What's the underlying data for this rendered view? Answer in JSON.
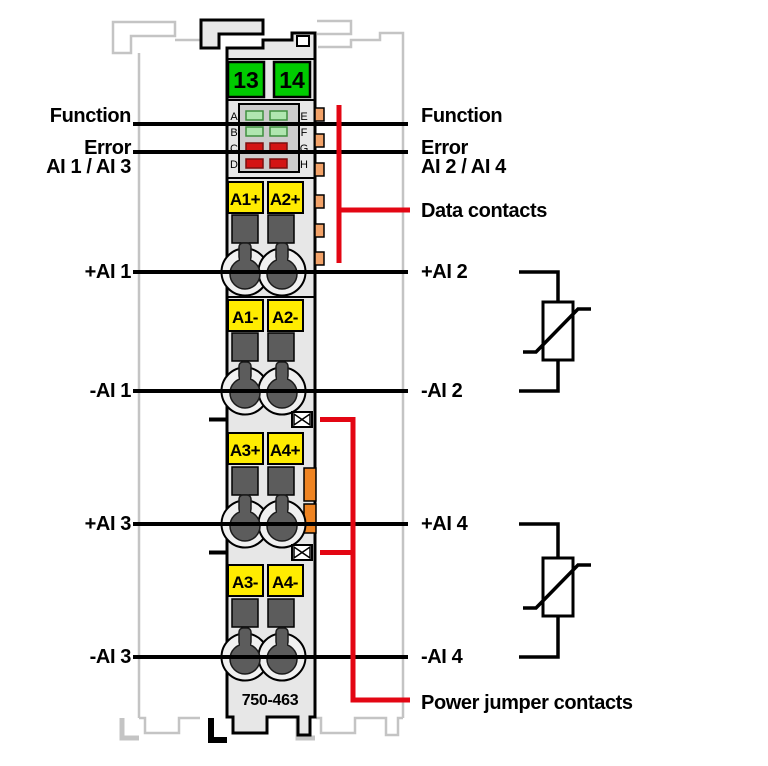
{
  "colors": {
    "body": "#e7e7e7",
    "panel": "#cccccc",
    "neighbor": "#c4c4c4",
    "green": "#00cc00",
    "yellow": "#ffec00",
    "red": "#e30613",
    "contact_orange": "#f2a268",
    "jumper_orange": "#ef8422",
    "led_green": "#b0e6b0",
    "led_green_border": "#3f8f3f",
    "led_red": "#d31414",
    "led_red_border": "#7d0f0f",
    "clamp_dark": "#5c5c5c",
    "black": "#000000"
  },
  "module": {
    "part_number": "750-463",
    "power_jumper_terminals": [
      "13",
      "14"
    ],
    "led_labels_left": [
      "A",
      "B",
      "C",
      "D"
    ],
    "led_labels_right": [
      "E",
      "F",
      "G",
      "H"
    ],
    "terminals": [
      "A1+",
      "A2+",
      "A1-",
      "A2-",
      "A3+",
      "A4+",
      "A3-",
      "A4-"
    ]
  },
  "labels": {
    "left_function": "Function",
    "left_error": "Error",
    "left_channels": "AI 1 / AI 3",
    "right_function": "Function",
    "right_error": "Error",
    "right_channels": "AI 2 / AI 4",
    "data_contacts": "Data contacts",
    "power_jumper": "Power jumper contacts",
    "ai1_plus": "+AI 1",
    "ai1_minus": "-AI 1",
    "ai2_plus": "+AI 2",
    "ai2_minus": "-AI 2",
    "ai3_plus": "+AI 3",
    "ai3_minus": "-AI 3",
    "ai4_plus": "+AI 4",
    "ai4_minus": "-AI 4"
  }
}
